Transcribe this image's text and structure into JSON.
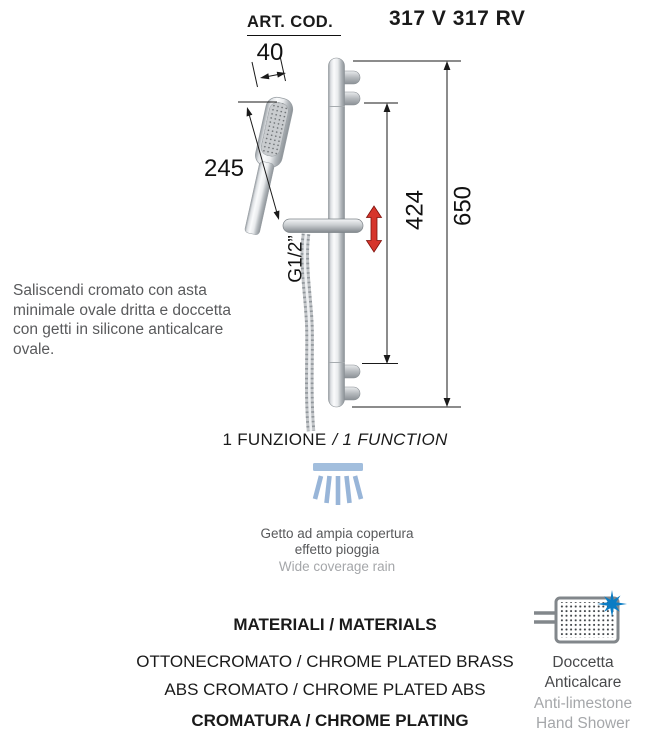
{
  "header": {
    "art_cod_label": "ART. COD.",
    "art_code": "317 V 317 RV"
  },
  "diagram": {
    "dims": {
      "head_width": "40",
      "hand_shower_length": "245",
      "slide_travel": "424",
      "bar_height": "650"
    },
    "thread_label": "G1/2”"
  },
  "description": {
    "text": "Saliscendi cromato con asta minimale ovale dritta e doccetta con getti in silicone anticalcare ovale."
  },
  "function_section": {
    "label_it": "1 FUNZIONE",
    "label_en": "/ 1 FUNCTION",
    "jet_caption_it": "Getto ad ampia copertura effetto pioggia",
    "jet_caption_en": "Wide coverage rain"
  },
  "materials": {
    "title": "MATERIALI / MATERIALS",
    "lines": [
      "OTTONECROMATO / CHROME PLATED BRASS",
      "ABS CROMATO / CHROME PLATED ABS"
    ],
    "plating": "CROMATURA / CHROME PLATING"
  },
  "badge": {
    "label_it": "Doccetta Anticalcare",
    "label_en": "Anti-limestone Hand Shower"
  },
  "colors": {
    "accent_red": "#d6352b",
    "spray_blue": "#98b5d8",
    "star_blue": "#0a7cc4",
    "text_gray": "#58595b",
    "text_light_gray": "#a5a7aa"
  }
}
